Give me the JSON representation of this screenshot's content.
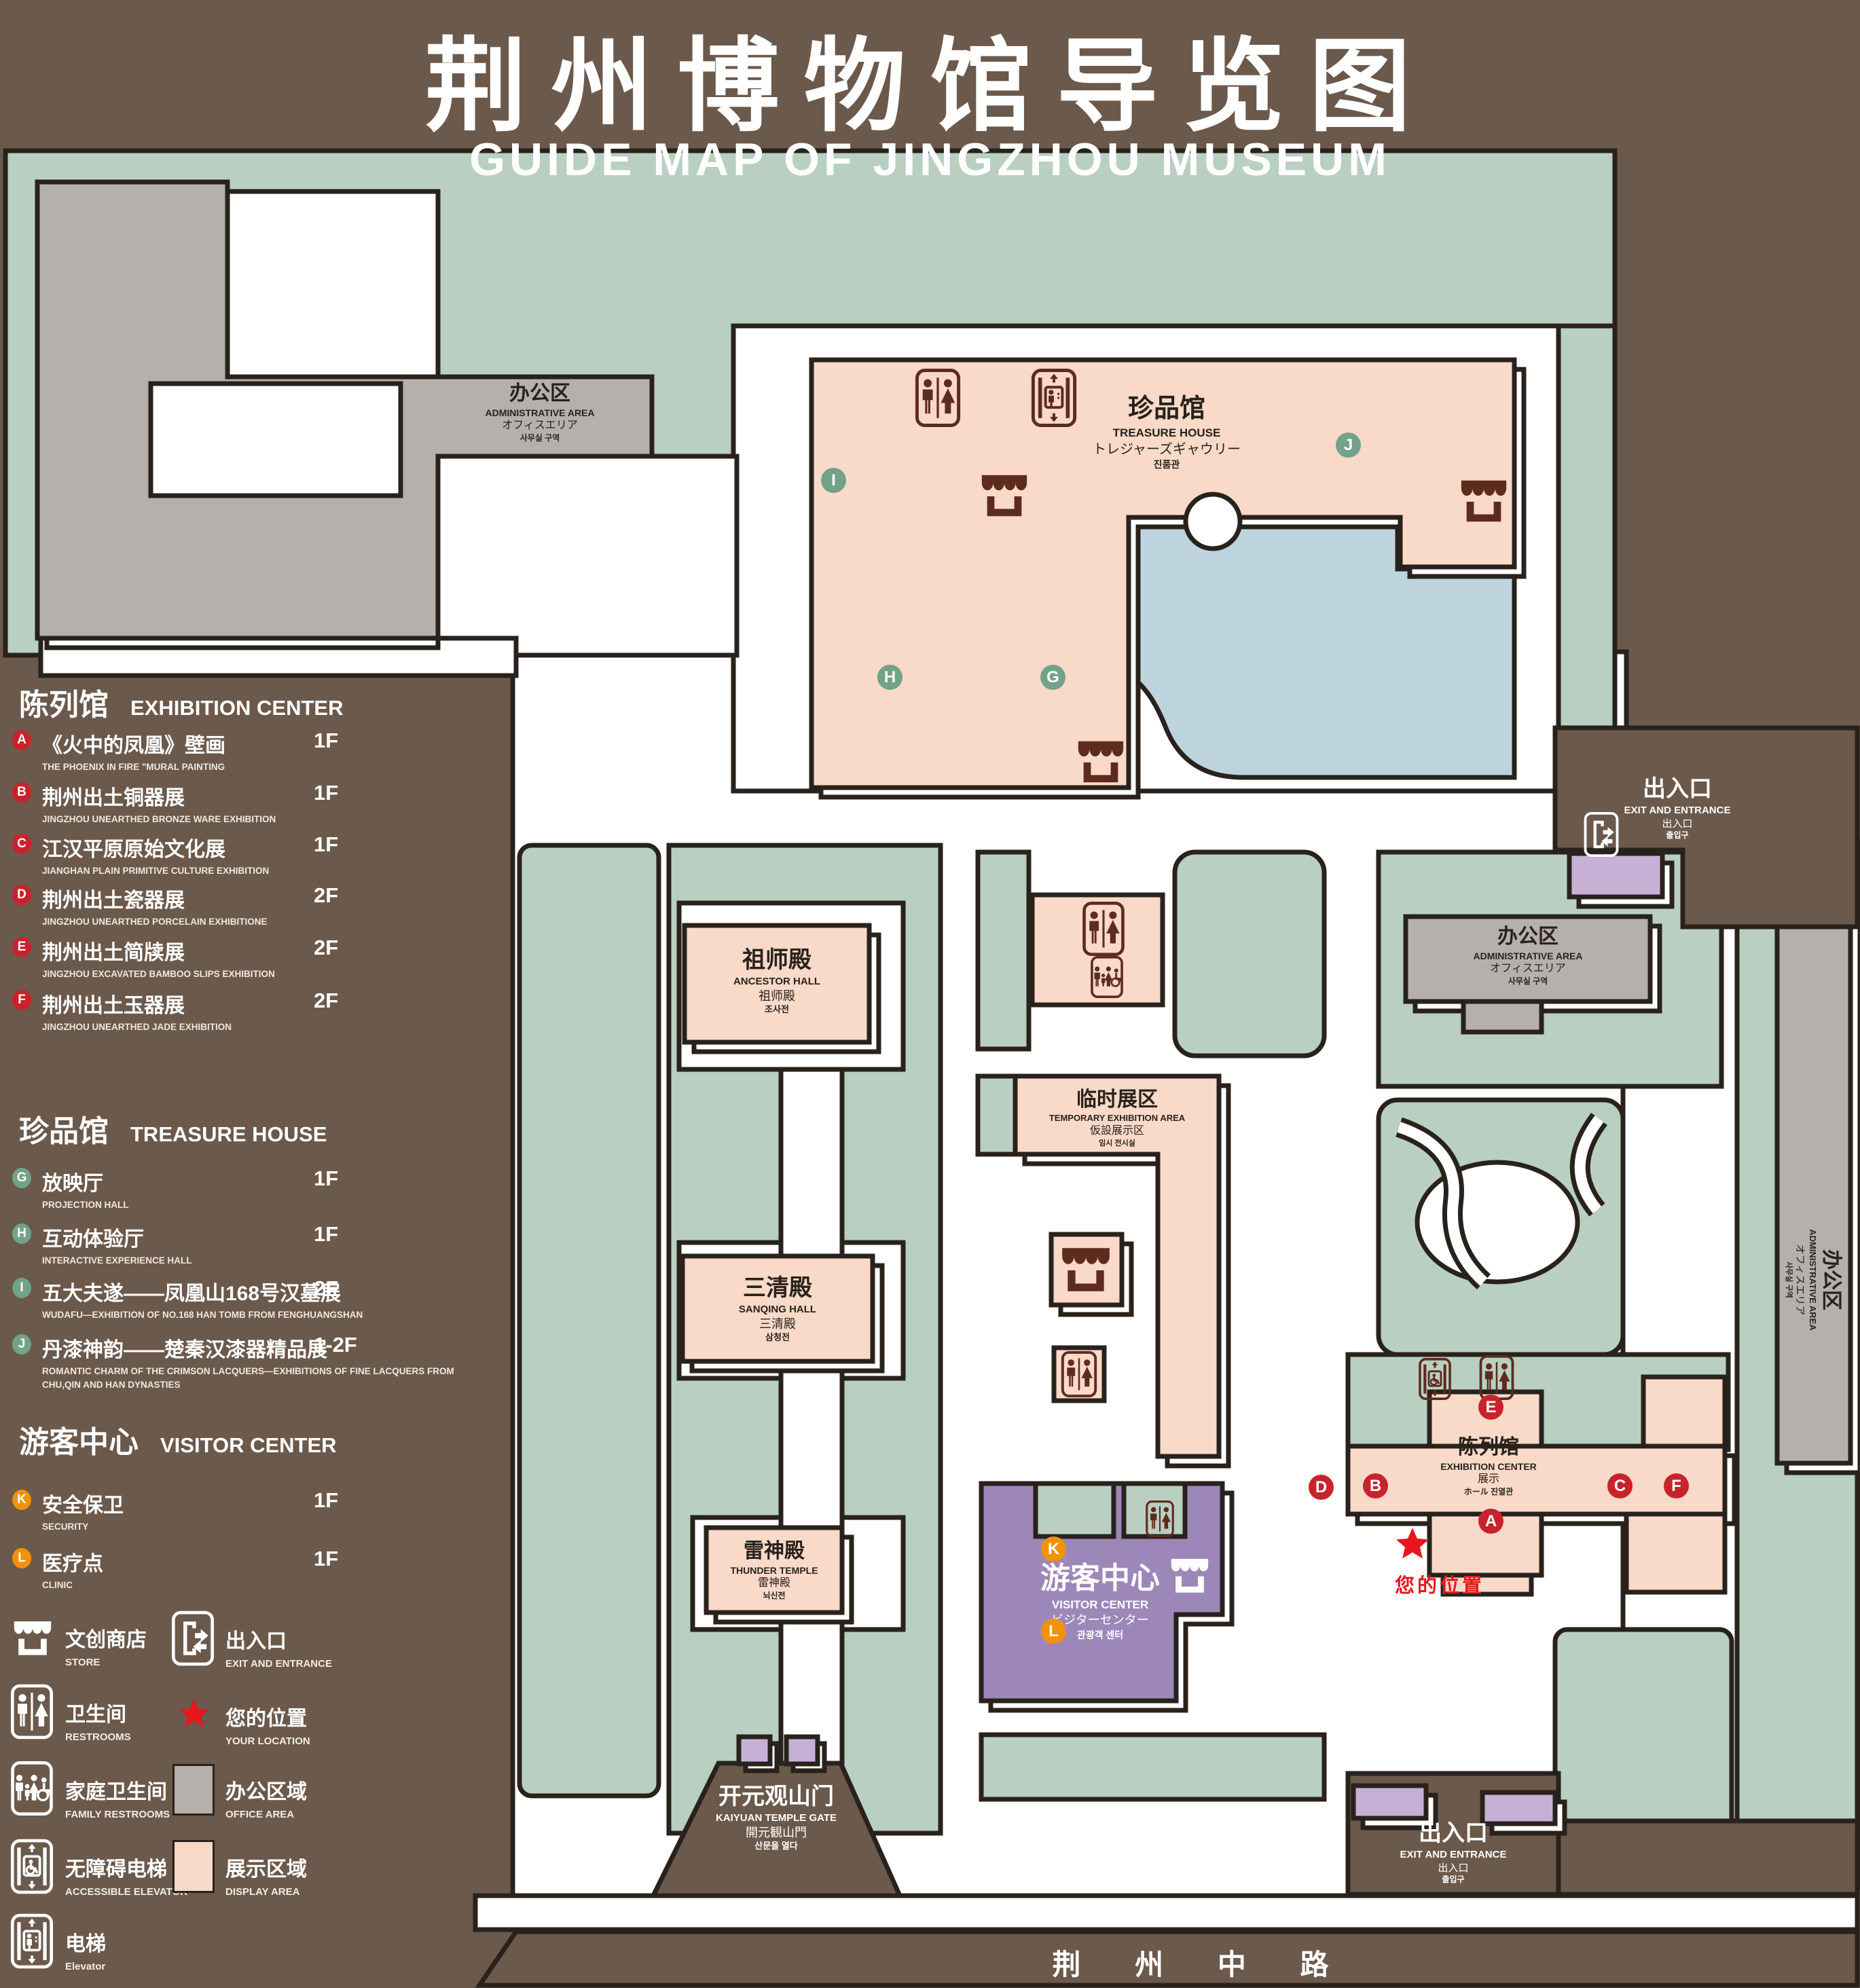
{
  "title": {
    "zh": "荆州博物馆导览图",
    "en": "GUIDE MAP OF JINGZHOU MUSEUM"
  },
  "colors": {
    "bg": "#6b594c",
    "outline": "#29221c",
    "lawn": "#b9cfc1",
    "peach": "#f9d9c8",
    "gray": "#b5b0ab",
    "lake": "#bdd4df",
    "purple": "#9d87b8",
    "lilac": "#c6b0d6",
    "road": "#6b594c",
    "red": "#c8232c",
    "green": "#72a287",
    "orange": "#f2920a",
    "icon_dark": "#5e2b1f",
    "star": "#e8161d",
    "white": "#ffffff"
  },
  "legend": {
    "sections": [
      {
        "zh": "陈列馆",
        "en": "EXHIBITION CENTER",
        "items": [
          {
            "id": "A",
            "zh": "《火中的凤凰》壁画",
            "en": "THE PHOENIX IN FIRE \"MURAL PAINTING",
            "floor": "1F"
          },
          {
            "id": "B",
            "zh": "荆州出土铜器展",
            "en": "JINGZHOU UNEARTHED BRONZE WARE EXHIBITION",
            "floor": "1F"
          },
          {
            "id": "C",
            "zh": "江汉平原原始文化展",
            "en": "JIANGHAN PLAIN PRIMITIVE CULTURE EXHIBITION",
            "floor": "1F"
          },
          {
            "id": "D",
            "zh": "荆州出土瓷器展",
            "en": "JINGZHOU UNEARTHED PORCELAIN EXHIBITIONE",
            "floor": "2F"
          },
          {
            "id": "E",
            "zh": "荆州出土简牍展",
            "en": "JINGZHOU EXCAVATED BAMBOO SLIPS EXHIBITION",
            "floor": "2F"
          },
          {
            "id": "F",
            "zh": "荆州出土玉器展",
            "en": "JINGZHOU UNEARTHED JADE EXHIBITION",
            "floor": "2F"
          }
        ]
      },
      {
        "zh": "珍品馆",
        "en": "TREASURE HOUSE",
        "items": [
          {
            "id": "G",
            "zh": "放映厅",
            "en": "PROJECTION HALL",
            "floor": "1F"
          },
          {
            "id": "H",
            "zh": "互动体验厅",
            "en": "INTERACTIVE EXPERIENCE HALL",
            "floor": "1F"
          },
          {
            "id": "I",
            "zh": "五大夫遂——凤凰山168号汉墓展",
            "en": "WUDAFU—EXHIBITION OF NO.168 HAN TOMB FROM FENGHUANGSHAN",
            "floor": "2F"
          },
          {
            "id": "J",
            "zh": "丹漆神韵——楚秦汉漆器精品展",
            "en": "ROMANTIC CHARM OF THE CRIMSON LACQUERS—EXHIBITIONS OF FINE LACQUERS FROM CHU,QIN AND HAN DYNASTIES",
            "floor": "1-2F"
          }
        ]
      },
      {
        "zh": "游客中心",
        "en": "VISITOR CENTER",
        "items": [
          {
            "id": "K",
            "zh": "安全保卫",
            "en": "SECURITY",
            "floor": "1F"
          },
          {
            "id": "L",
            "zh": "医疗点",
            "en": "CLINIC",
            "floor": "1F"
          }
        ]
      }
    ],
    "symbols": [
      {
        "zh": "文创商店",
        "en": "STORE"
      },
      {
        "zh": "出入口",
        "en": "EXIT AND ENTRANCE"
      },
      {
        "zh": "卫生间",
        "en": "RESTROOMS"
      },
      {
        "zh": "您的位置",
        "en": "YOUR LOCATION"
      },
      {
        "zh": "家庭卫生间",
        "en": "FAMILY RESTROOMS"
      },
      {
        "zh": "办公区域",
        "en": "OFFICE AREA"
      },
      {
        "zh": "无障碍电梯",
        "en": "ACCESSIBLE ELEVATOR"
      },
      {
        "zh": "展示区域",
        "en": "DISPLAY AREA"
      },
      {
        "zh": "电梯",
        "en": "Elevator"
      }
    ]
  },
  "map": {
    "admin": {
      "zh": "办公区",
      "en": "ADMINISTRATIVE AREA",
      "ja": "オフィスエリア",
      "ko": "사무실 구역"
    },
    "treasure": {
      "zh": "珍品馆",
      "en": "TREASURE HOUSE",
      "ja": "トレジャーズギャウリー",
      "ko": "진품관"
    },
    "ancestor": {
      "zh": "祖师殿",
      "en": "ANCESTOR HALL",
      "ja": "祖师殿",
      "ko": "조사전"
    },
    "temporary": {
      "zh": "临时展区",
      "en": "TEMPORARY EXHIBITION AREA",
      "ja": "仮設展示区",
      "ko": "임시 전시실"
    },
    "sanqing": {
      "zh": "三清殿",
      "en": "SANQING HALL",
      "ja": "三清殿",
      "ko": "삼청전"
    },
    "thunder": {
      "zh": "雷神殿",
      "en": "THUNDER TEMPLE",
      "ja": "雷神殿",
      "ko": "뇌신전"
    },
    "visitor": {
      "zh": "游客中心",
      "en": "VISITOR CENTER",
      "ja": "ビジターセンター",
      "ko": "관광객 센터"
    },
    "exhibition": {
      "zh": "陈列馆",
      "en": "EXHIBITION CENTER",
      "ja": "展示",
      "ko": "ホール 진열관"
    },
    "exit": {
      "zh": "出入口",
      "en": "EXIT AND ENTRANCE",
      "ja": "出入口",
      "ko": "출입구"
    },
    "gate": {
      "zh": "开元观山门",
      "en": "KAIYUAN TEMPLE GATE",
      "ja": "開元観山門",
      "ko": "산문을 열다"
    },
    "road": "荆 州 中 路",
    "your_location": "您的位置"
  }
}
